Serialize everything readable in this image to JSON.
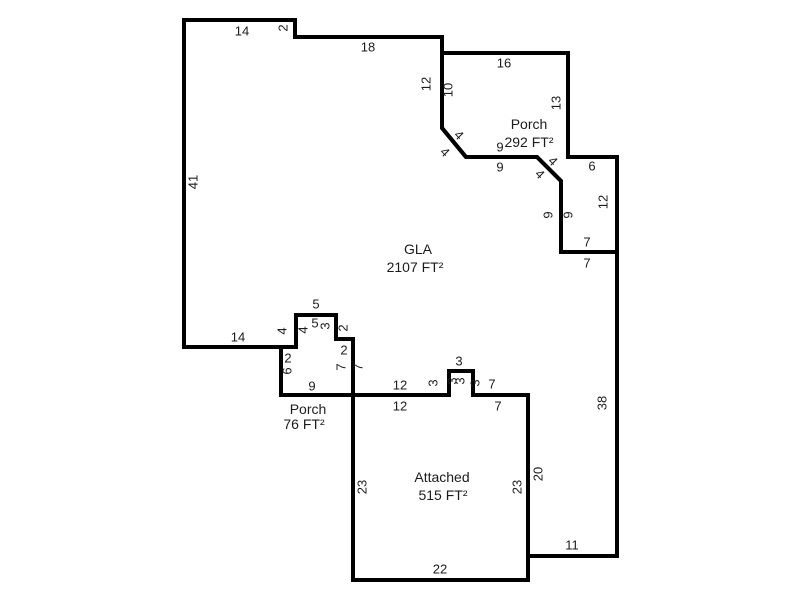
{
  "canvas": {
    "width": 800,
    "height": 600,
    "background": "#ffffff",
    "line_color": "#000000",
    "text_color": "#1c1c1c"
  },
  "areas": [
    {
      "id": "gla",
      "name_label": "GLA",
      "area_label": "2107 FT²",
      "name_pos": {
        "x": 418,
        "y": 249
      },
      "area_pos": {
        "x": 415,
        "y": 267
      },
      "points": [
        [
          184,
          20
        ],
        [
          295,
          20
        ],
        [
          295,
          37
        ],
        [
          442,
          37
        ],
        [
          442,
          128
        ],
        [
          466,
          157
        ],
        [
          537,
          157
        ],
        [
          561,
          181
        ],
        [
          561,
          252
        ],
        [
          617,
          252
        ],
        [
          617,
          556
        ],
        [
          528,
          556
        ],
        [
          528,
          395
        ],
        [
          473,
          395
        ],
        [
          473,
          371
        ],
        [
          449,
          371
        ],
        [
          449,
          395
        ],
        [
          353,
          395
        ],
        [
          353,
          339
        ],
        [
          336,
          339
        ],
        [
          336,
          315
        ],
        [
          296,
          315
        ],
        [
          296,
          347
        ],
        [
          184,
          347
        ]
      ]
    },
    {
      "id": "porch-upper",
      "name_label": "Porch",
      "area_label": "292 FT²",
      "name_pos": {
        "x": 529,
        "y": 124
      },
      "area_pos": {
        "x": 529,
        "y": 142
      },
      "points": [
        [
          442,
          53
        ],
        [
          568,
          53
        ],
        [
          568,
          157
        ],
        [
          617,
          157
        ],
        [
          617,
          252
        ],
        [
          561,
          252
        ],
        [
          561,
          181
        ],
        [
          537,
          157
        ],
        [
          466,
          157
        ],
        [
          442,
          128
        ]
      ]
    },
    {
      "id": "porch-lower",
      "name_label": "Porch",
      "area_label": "76 FT²",
      "name_pos": {
        "x": 308,
        "y": 409
      },
      "area_pos": {
        "x": 304,
        "y": 424
      },
      "points": [
        [
          281,
          347
        ],
        [
          296,
          347
        ],
        [
          296,
          315
        ],
        [
          336,
          315
        ],
        [
          336,
          339
        ],
        [
          353,
          339
        ],
        [
          353,
          395
        ],
        [
          281,
          395
        ]
      ]
    },
    {
      "id": "attached",
      "name_label": "Attached",
      "area_label": "515 FT²",
      "name_pos": {
        "x": 442,
        "y": 477
      },
      "area_pos": {
        "x": 443,
        "y": 495
      },
      "points": [
        [
          353,
          395
        ],
        [
          449,
          395
        ],
        [
          449,
          371
        ],
        [
          473,
          371
        ],
        [
          473,
          395
        ],
        [
          528,
          395
        ],
        [
          528,
          580
        ],
        [
          353,
          580
        ]
      ]
    }
  ],
  "dimensions": [
    {
      "t": "14",
      "x": 242,
      "y": 31,
      "r": 0
    },
    {
      "t": "2",
      "x": 283,
      "y": 28,
      "r": -90
    },
    {
      "t": "18",
      "x": 368,
      "y": 47,
      "r": 0
    },
    {
      "t": "12",
      "x": 426,
      "y": 84,
      "r": -90
    },
    {
      "t": "10",
      "x": 448,
      "y": 90,
      "r": -90
    },
    {
      "t": "16",
      "x": 504,
      "y": 63,
      "r": 0
    },
    {
      "t": "13",
      "x": 556,
      "y": 103,
      "r": -90
    },
    {
      "t": "4",
      "x": 459,
      "y": 135,
      "r": 45
    },
    {
      "t": "4",
      "x": 445,
      "y": 152,
      "r": 45
    },
    {
      "t": "9",
      "x": 500,
      "y": 147,
      "r": 0
    },
    {
      "t": "9",
      "x": 500,
      "y": 167,
      "r": 0
    },
    {
      "t": "4",
      "x": 553,
      "y": 161,
      "r": 45
    },
    {
      "t": "4",
      "x": 540,
      "y": 174,
      "r": 45
    },
    {
      "t": "6",
      "x": 592,
      "y": 166,
      "r": 0
    },
    {
      "t": "9",
      "x": 548,
      "y": 215,
      "r": -90
    },
    {
      "t": "9",
      "x": 568,
      "y": 215,
      "r": -90
    },
    {
      "t": "12",
      "x": 603,
      "y": 202,
      "r": -90
    },
    {
      "t": "7",
      "x": 587,
      "y": 242,
      "r": 0
    },
    {
      "t": "7",
      "x": 587,
      "y": 263,
      "r": 0
    },
    {
      "t": "41",
      "x": 193,
      "y": 182,
      "r": -90
    },
    {
      "t": "38",
      "x": 602,
      "y": 403,
      "r": -90
    },
    {
      "t": "14",
      "x": 238,
      "y": 337,
      "r": 0
    },
    {
      "t": "5",
      "x": 316,
      "y": 304,
      "r": 0
    },
    {
      "t": "4",
      "x": 282,
      "y": 331,
      "r": -90
    },
    {
      "t": "4",
      "x": 303,
      "y": 330,
      "r": -90
    },
    {
      "t": "5",
      "x": 315,
      "y": 323,
      "r": 0
    },
    {
      "t": "3",
      "x": 325,
      "y": 326,
      "r": -90
    },
    {
      "t": "2",
      "x": 343,
      "y": 328,
      "r": -90
    },
    {
      "t": "2",
      "x": 288,
      "y": 358,
      "r": 0
    },
    {
      "t": "6",
      "x": 287,
      "y": 371,
      "r": -90
    },
    {
      "t": "2",
      "x": 344,
      "y": 350,
      "r": 0
    },
    {
      "t": "7",
      "x": 341,
      "y": 367,
      "r": -90
    },
    {
      "t": "7",
      "x": 358,
      "y": 367,
      "r": -90
    },
    {
      "t": "9",
      "x": 312,
      "y": 386,
      "r": 0
    },
    {
      "t": "12",
      "x": 400,
      "y": 385,
      "r": 0
    },
    {
      "t": "12",
      "x": 400,
      "y": 406,
      "r": 0
    },
    {
      "t": "3",
      "x": 433,
      "y": 383,
      "r": -90
    },
    {
      "t": "3",
      "x": 452,
      "y": 381,
      "r": -90
    },
    {
      "t": "3",
      "x": 460,
      "y": 381,
      "r": -90
    },
    {
      "t": "3",
      "x": 475,
      "y": 383,
      "r": -90
    },
    {
      "t": "3",
      "x": 459,
      "y": 361,
      "r": 0
    },
    {
      "t": "7",
      "x": 492,
      "y": 384,
      "r": 0
    },
    {
      "t": "7",
      "x": 498,
      "y": 406,
      "r": 0
    },
    {
      "t": "23",
      "x": 362,
      "y": 487,
      "r": -90
    },
    {
      "t": "23",
      "x": 517,
      "y": 487,
      "r": -90
    },
    {
      "t": "20",
      "x": 538,
      "y": 474,
      "r": -90
    },
    {
      "t": "22",
      "x": 440,
      "y": 569,
      "r": 0
    },
    {
      "t": "11",
      "x": 572,
      "y": 545,
      "r": 0
    }
  ]
}
